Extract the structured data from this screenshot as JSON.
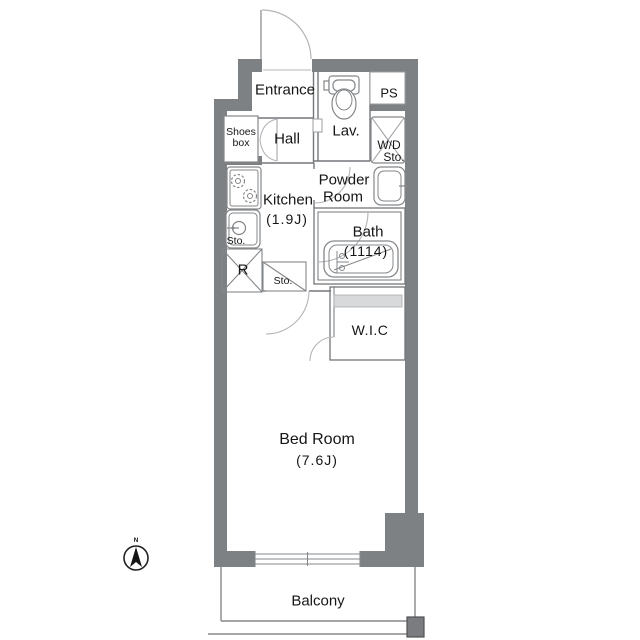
{
  "title": "Apartment floor plan",
  "colors": {
    "background": "#ffffff",
    "wall": "#7e8184",
    "thin_line": "#74777a",
    "fixture_line": "#84878a",
    "light_line": "#9a9da0",
    "door_arc": "#b2b4b7",
    "shelf_fill": "#d7d9db",
    "text": "#161616",
    "balcony_post": "#7a7c80"
  },
  "labels": {
    "entrance": "Entrance",
    "hall": "Hall",
    "shoes_box_line1": "Shoes",
    "shoes_box_line2": "box",
    "lavatory": "Lav.",
    "pipe_space": "PS",
    "wd_storage_line1": "W/D",
    "wd_storage_line2": "Sto.",
    "powder_room_line1": "Powder",
    "powder_room_line2": "Room",
    "kitchen_line1": "Kitchen",
    "kitchen_line2": "(1.9J)",
    "kitchen_storage": "Sto.",
    "refrigerator_space": "R",
    "hall_storage": "Sto.",
    "bath_line1": "Bath",
    "bath_line2": "(1114)",
    "walk_in_closet": "W.I.C",
    "bedroom_line1": "Bed Room",
    "bedroom_line2": "(7.6J)",
    "balcony": "Balcony",
    "compass_north": "N"
  }
}
